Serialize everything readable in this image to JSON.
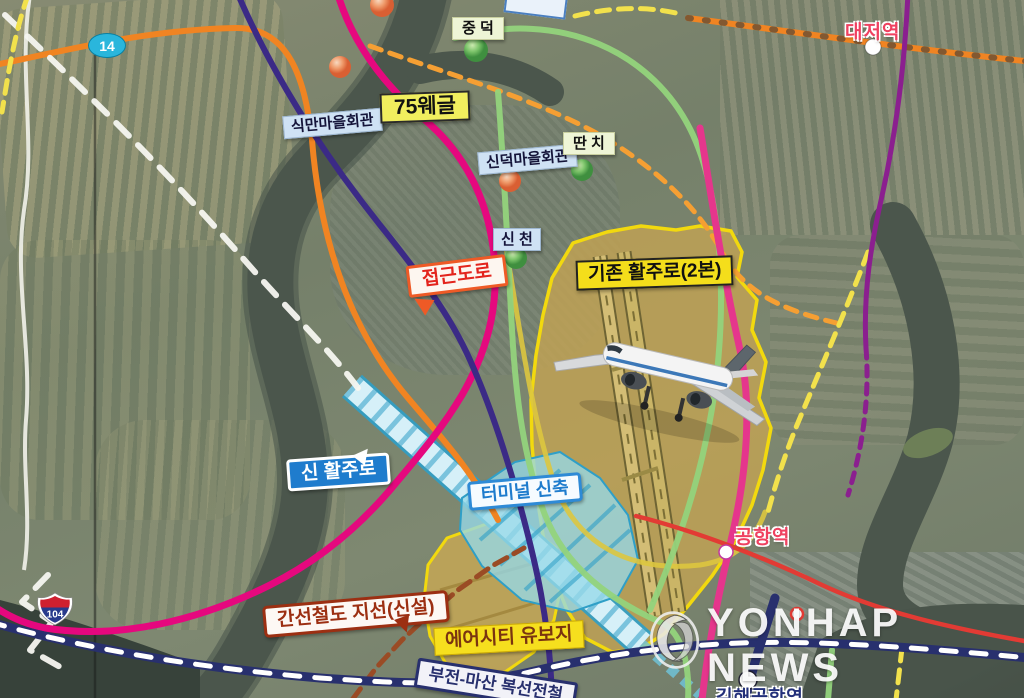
{
  "map": {
    "labels": {
      "sikman_village_hall": "식만마을회관",
      "jungdeok": "중 덕",
      "route_75_label": "75웨글",
      "sindeok_village_hall": "신덕마을회관",
      "ttanchi": "딴 치",
      "sincheon": "신 천",
      "access_road": "접근도로",
      "existing_runway": "기존 활주로(2본)",
      "new_runway": "신 활주로",
      "terminal_new": "터미널 신축",
      "trunk_rail_branch": "간선철도 지선(신설)",
      "aircity_reserve": "에어시티 유보지",
      "airport_station": "공항역",
      "daejeo_station": "대저역",
      "gimhae_airport_station": "김해공항역",
      "bujeon_masan_line": "부전-마산 복선전철"
    },
    "route_shields": {
      "route_14": "14",
      "route_104": "104"
    },
    "watermark": {
      "text": "YONHAP NEWS"
    }
  },
  "palette": {
    "magenta_road": "#e5087e",
    "orange_road": "#f08422",
    "orange_dash": "#f59f33",
    "purple_rail": "#3b2a86",
    "green_line": "#93d37c",
    "yellow_dash": "#f2e14c",
    "navy_line": "#28306e",
    "red_line": "#e23b34",
    "pink_lrt": "#e5368c",
    "boundary_yellow": "#f2d90e",
    "runway_blue": "#2f9fc7",
    "water": "#4b564c",
    "label_red": "#e3241d",
    "label_blue": "#1f7ccd",
    "label_darkred": "#9c2f12",
    "station_red": "#ef4160",
    "station_navy": "#23307a",
    "shield_cyan": "#2ab6dc"
  }
}
